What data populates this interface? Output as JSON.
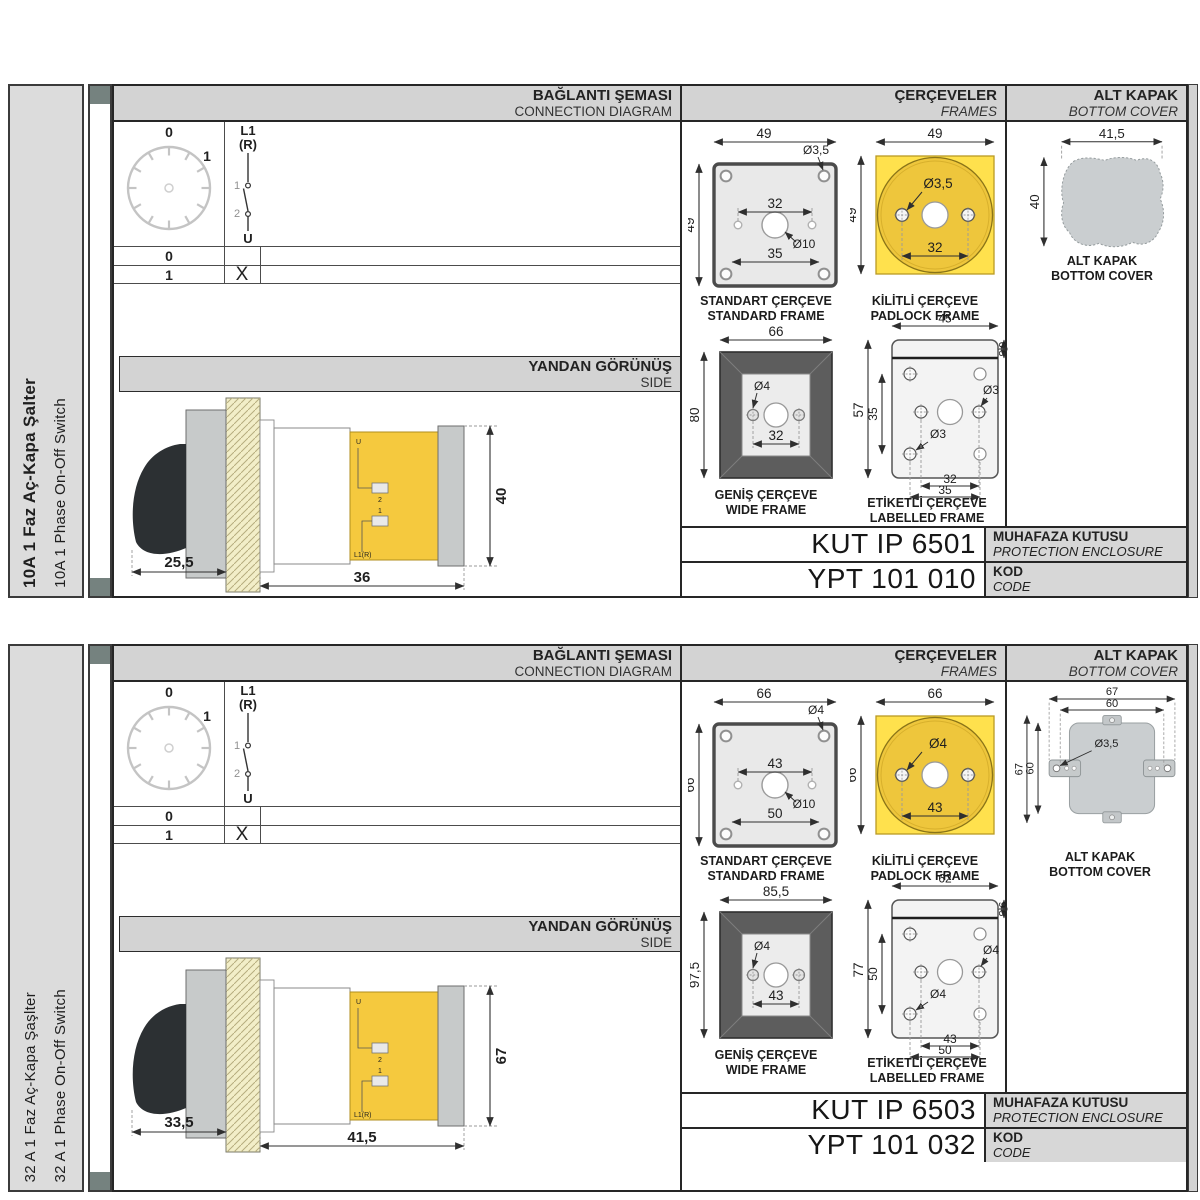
{
  "colors": {
    "bar": "#d3d3d3",
    "sidebar": "#dcdcdc",
    "square": "#75827f",
    "yellow": "#ffe14d",
    "yellow_dark": "#eec63c",
    "wide_frame": "#5d5d5d",
    "cover_gray": "#caced0",
    "terminal_yellow": "#f5c93e"
  },
  "sections": [
    {
      "sidebar": {
        "title_tr": "10A 1 Faz Aç-Kapa Şalter",
        "title_en": "10A 1 Phase On-Off Switch"
      },
      "headers": {
        "connection_tr": "BAĞLANTI ŞEMASI",
        "connection_en": "CONNECTION DIAGRAM",
        "frames_tr": "ÇERÇEVELER",
        "frames_en": "FRAMES",
        "cover_tr": "ALT KAPAK",
        "cover_en": "BOTTOM COVER",
        "side_tr": "YANDAN GÖRÜNÜŞ",
        "side_en": "SIDE"
      },
      "diagram": {
        "pos0": "0",
        "pos1": "1",
        "l1": "L1",
        "r": "(R)",
        "c1": "1",
        "c2": "2",
        "u": "U",
        "rows": [
          {
            "pos": "0",
            "mark": ""
          },
          {
            "pos": "1",
            "mark": "X"
          }
        ]
      },
      "side": {
        "a": "25,5",
        "b": "36",
        "h": "40",
        "u": "U",
        "t2": "2",
        "t1": "1",
        "l1": "L1(R)"
      },
      "frames": {
        "standard": {
          "tr": "STANDART ÇERÇEVE",
          "en": "STANDARD FRAME",
          "w": "49",
          "h": "49",
          "hole": "Ø3,5",
          "inner": "32",
          "center": "Ø10",
          "lower": "35"
        },
        "padlock": {
          "tr": "KİLİTLİ ÇERÇEVE",
          "en": "PADLOCK FRAME",
          "w": "49",
          "h": "49",
          "hole": "Ø3,5",
          "inner": "32"
        },
        "wide": {
          "tr": "GENİŞ ÇERÇEVE",
          "en": "WIDE FRAME",
          "w": "66",
          "h": "80",
          "hole": "Ø4",
          "inner": "32"
        },
        "labelled": {
          "tr": "ETİKETLİ ÇERÇEVE",
          "en": "LABELLED FRAME",
          "w": "45",
          "strip": "6,5",
          "h": "57",
          "ih": "35",
          "hole_r": "Ø3",
          "hole_b": "Ø3",
          "d1": "32",
          "d2": "35"
        }
      },
      "cover": {
        "tr": "ALT KAPAK",
        "en": "BOTTOM COVER",
        "w": "41,5",
        "h": "40"
      },
      "codes": {
        "enclosure": "KUT IP 6501",
        "enclosure_tr": "MUHAFAZA KUTUSU",
        "enclosure_en": "PROTECTION ENCLOSURE",
        "code": "YPT 101 010",
        "code_tr": "KOD",
        "code_en": "CODE"
      }
    },
    {
      "sidebar": {
        "title_tr": "32 A 1 Faz Aç-Kapa Şaşlter",
        "title_en": "32 A 1 Phase On-Off Switch"
      },
      "headers": {
        "connection_tr": "BAĞLANTI ŞEMASI",
        "connection_en": "CONNECTION DIAGRAM",
        "frames_tr": "ÇERÇEVELER",
        "frames_en": "FRAMES",
        "cover_tr": "ALT KAPAK",
        "cover_en": "BOTTOM COVER",
        "side_tr": "YANDAN GÖRÜNÜŞ",
        "side_en": "SIDE"
      },
      "diagram": {
        "pos0": "0",
        "pos1": "1",
        "l1": "L1",
        "r": "(R)",
        "c1": "1",
        "c2": "2",
        "u": "U",
        "rows": [
          {
            "pos": "0",
            "mark": ""
          },
          {
            "pos": "1",
            "mark": "X"
          }
        ]
      },
      "side": {
        "a": "33,5",
        "b": "41,5",
        "h": "67",
        "u": "U",
        "t2": "2",
        "t1": "1",
        "l1": "L1(R)"
      },
      "frames": {
        "standard": {
          "tr": "STANDART ÇERÇEVE",
          "en": "STANDARD FRAME",
          "w": "66",
          "h": "66",
          "hole": "Ø4",
          "inner": "43",
          "center": "Ø10",
          "lower": "50"
        },
        "padlock": {
          "tr": "KİLİTLİ ÇERÇEVE",
          "en": "PADLOCK FRAME",
          "w": "66",
          "h": "66",
          "hole": "Ø4",
          "inner": "43"
        },
        "wide": {
          "tr": "GENİŞ ÇERÇEVE",
          "en": "WIDE FRAME",
          "w": "85,5",
          "h": "97,5",
          "hole": "Ø4",
          "inner": "43"
        },
        "labelled": {
          "tr": "ETİKETLİ ÇERÇEVE",
          "en": "LABELLED FRAME",
          "w": "62",
          "strip": "9,5",
          "h": "77",
          "ih": "50",
          "hole_r": "Ø4",
          "hole_b": "Ø4",
          "d1": "43",
          "d2": "50"
        }
      },
      "cover": {
        "tr": "ALT KAPAK",
        "en": "BOTTOM COVER",
        "w1": "67",
        "w2": "60",
        "h1": "67",
        "h2": "60",
        "hole": "Ø3,5"
      },
      "codes": {
        "enclosure": "KUT IP 6503",
        "enclosure_tr": "MUHAFAZA KUTUSU",
        "enclosure_en": "PROTECTION ENCLOSURE",
        "code": "YPT 101 032",
        "code_tr": "KOD",
        "code_en": "CODE"
      }
    }
  ]
}
